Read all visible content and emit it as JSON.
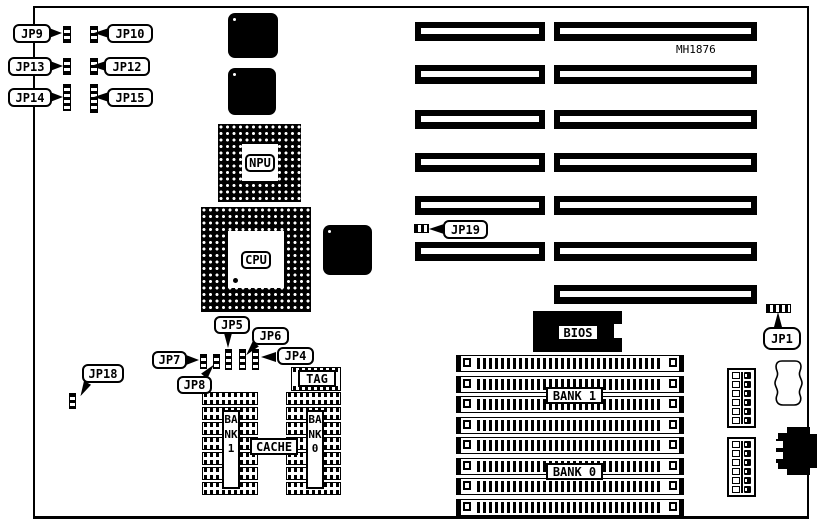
{
  "diagram": {
    "board_id": "MH1876",
    "labels": {
      "jp1": "JP1",
      "jp4": "JP4",
      "jp5": "JP5",
      "jp6": "JP6",
      "jp7": "JP7",
      "jp8": "JP8",
      "jp9": "JP9",
      "jp10": "JP10",
      "jp12": "JP12",
      "jp13": "JP13",
      "jp14": "JP14",
      "jp15": "JP15",
      "jp18": "JP18",
      "jp19": "JP19",
      "npu": "NPU",
      "cpu": "CPU",
      "bios": "BIOS",
      "tag": "TAG",
      "cache": "CACHE",
      "bank1_simm": "BANK 1",
      "bank0_simm": "BANK 0",
      "bank1_cache": "BANK1",
      "bank0_cache": "BANK0"
    },
    "expansion_slots": {
      "rows": [
        {
          "short": true,
          "long": true
        },
        {
          "short": true,
          "long": true
        },
        {
          "short": true,
          "long": true
        },
        {
          "short": true,
          "long": true
        },
        {
          "short": true,
          "long": true
        },
        {
          "short": true,
          "long": true
        },
        {
          "short": false,
          "long": true
        }
      ]
    },
    "simm_socket_count": 8,
    "cache_chip_rows": 7,
    "power_connector_count": 2,
    "power_connector_pin_rows": 6,
    "colors": {
      "ink": "#000000",
      "paper": "#ffffff"
    }
  }
}
